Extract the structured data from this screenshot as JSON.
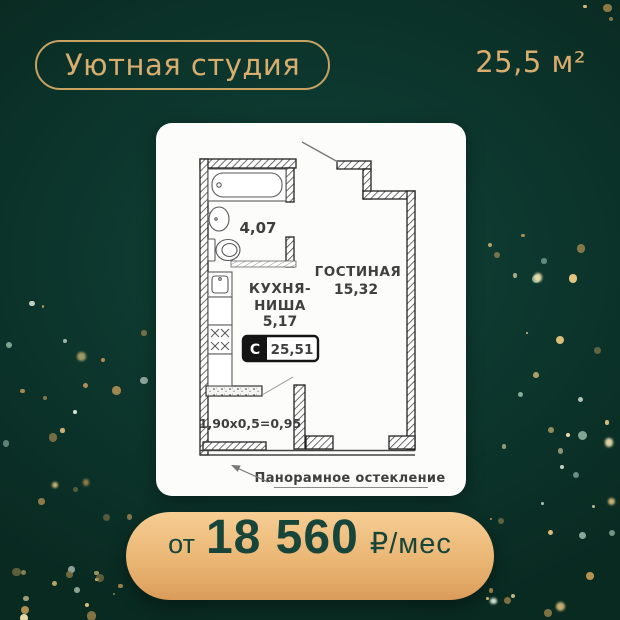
{
  "colors": {
    "background": "#0c352c",
    "gold": "#d9ad6e",
    "gold_border": "#c9a263",
    "card_background": "#fcfcfa",
    "button_gradient_top": "#f6cd93",
    "button_gradient_bottom": "#db9c5b",
    "button_text": "#17453a",
    "plan_ink": "#3f3f3f"
  },
  "header": {
    "badge_label": "Уютная студия",
    "total_area": "25,5 м²"
  },
  "floor_plan": {
    "bathroom_area": "4,07",
    "kitchen_line1": "КУХНЯ-",
    "kitchen_line2": "НИША",
    "kitchen_area": "5,17",
    "living_room_label": "ГОСТИНАЯ",
    "living_room_area": "15,32",
    "type_badge": "С",
    "plan_total_area": "25,51",
    "balcony_dimensions": "1,90х0,5=0,95",
    "glazing_label": "Панорамное остекление"
  },
  "price": {
    "prefix": "от",
    "amount": "18 560",
    "unit": "₽/мес"
  }
}
